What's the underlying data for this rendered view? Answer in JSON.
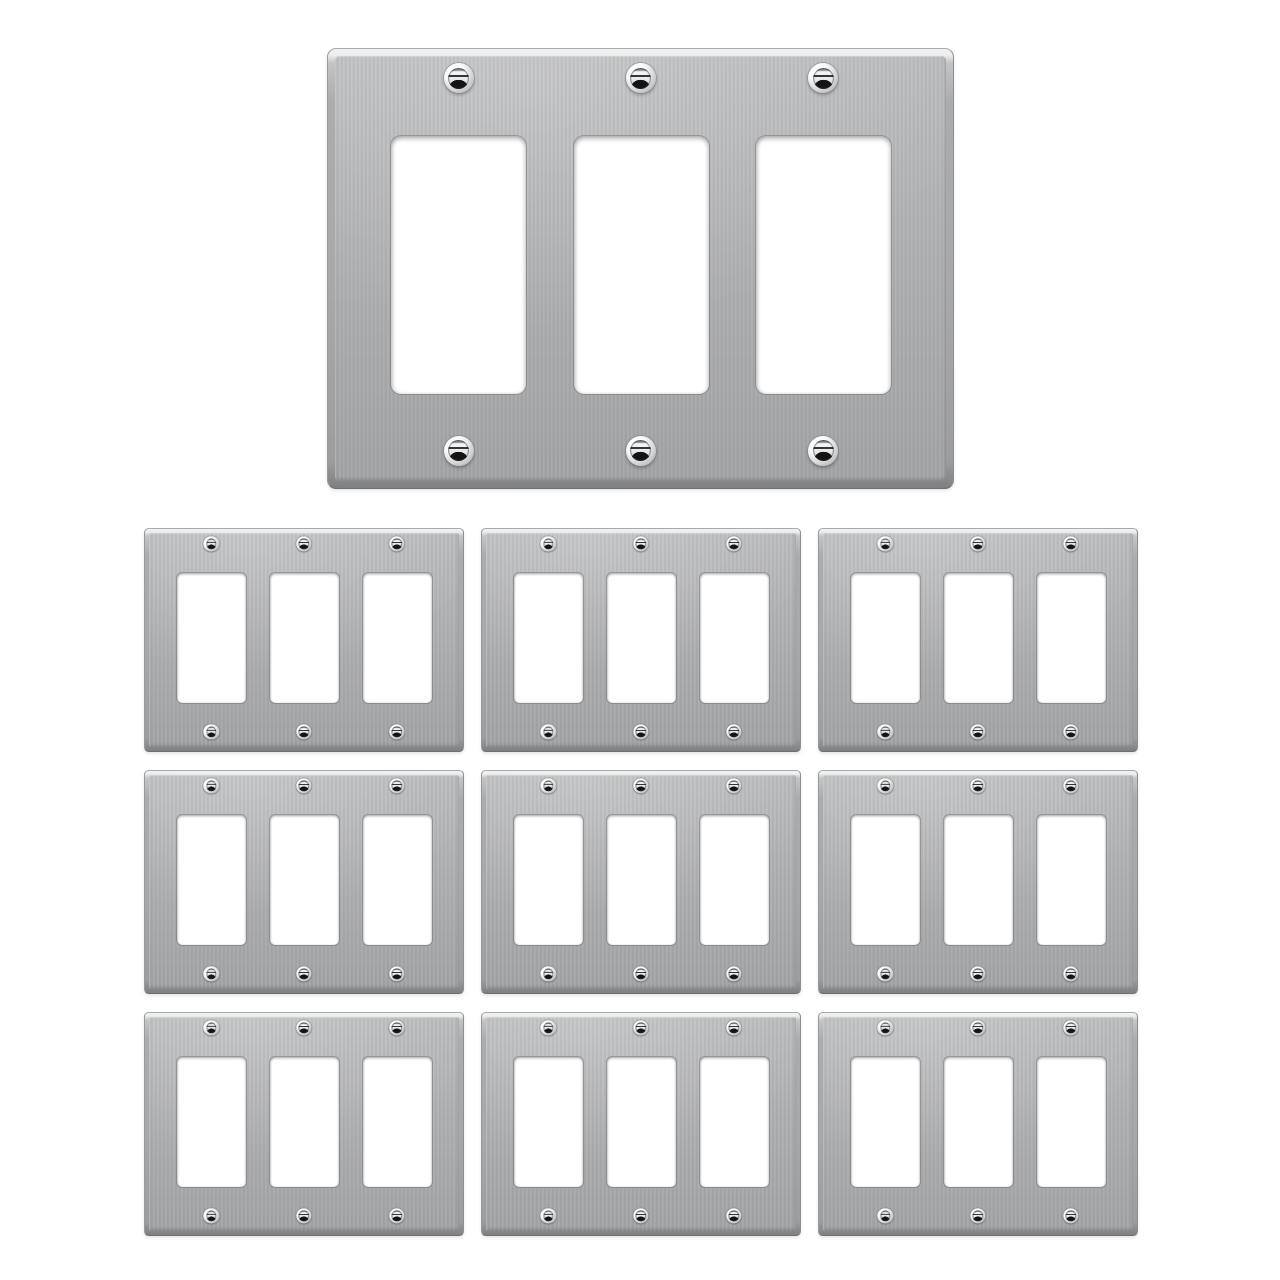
{
  "scene": {
    "kind": "product-photo",
    "plates_total": 10
  },
  "hero_plate": {
    "gang_count": 3,
    "cutout_count": 3,
    "screw_count": 6
  },
  "grid": {
    "rows": 3,
    "columns": 3,
    "plate_count": 9,
    "gangs_per_plate": 3,
    "screws_per_plate": 6
  },
  "palette": {
    "background": "#ffffff",
    "metal_face": "#b0b1b3",
    "metal_face_light": "#bcbdbf",
    "metal_face_dark": "#a4a5a7",
    "bevel_highlight": "#eceded",
    "bevel_shadow": "#7e7f81",
    "edge_line": "#8e8f91",
    "cutout_fill": "#ffffff",
    "screw_chrome": "#f7f8f9",
    "screw_slot": "#141414"
  }
}
